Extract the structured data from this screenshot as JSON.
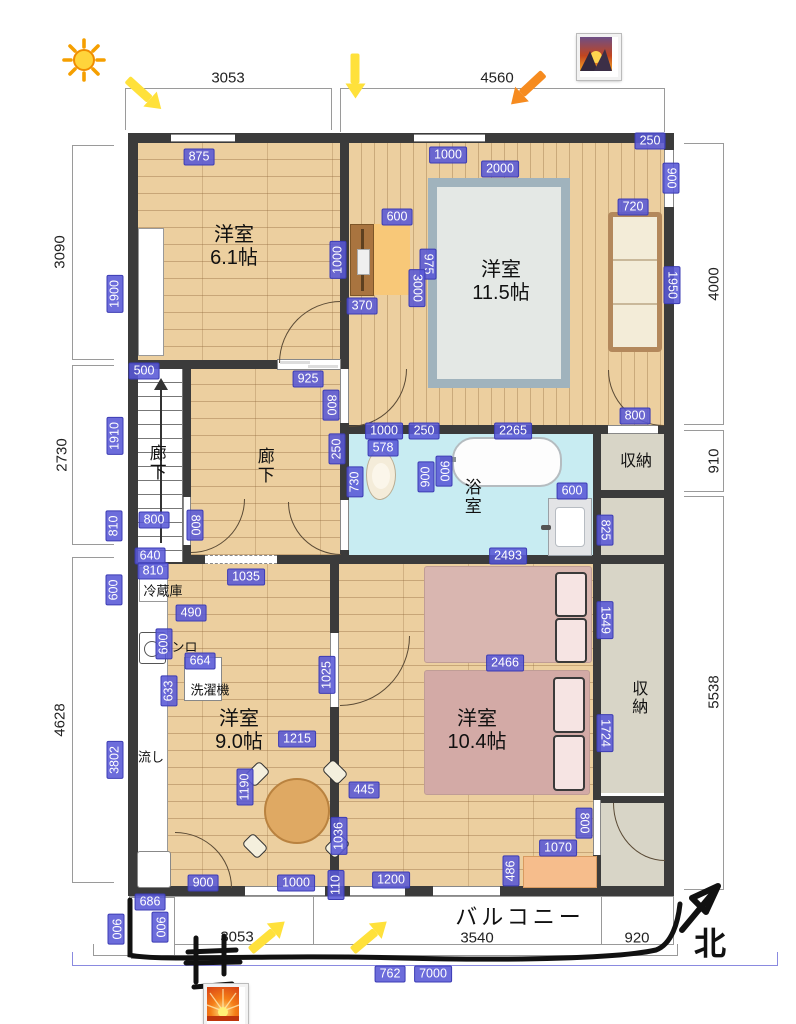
{
  "title": "間取り図 (floor plan)",
  "compass": {
    "label": "北"
  },
  "balcony_label": "バルコニー",
  "colors": {
    "badge_bg": "#5858d6",
    "wall": "#3b3b3b",
    "wood": "#eccf9f",
    "bath_floor": "#c8ecf2",
    "storage": "#d8d5c7",
    "bed": "#d9b6b0",
    "rug_border": "#a0b3bd",
    "rug_inner": "#e4e8e5",
    "arrow_yellow": "#ffe13b",
    "arrow_orange": "#f68b1f"
  },
  "icons": [
    {
      "name": "sun-icon"
    },
    {
      "name": "sunrise-photo-icon-top"
    },
    {
      "name": "sunrise-photo-icon-bottom"
    },
    {
      "name": "yellow-arrow-down-right"
    },
    {
      "name": "yellow-arrow-down"
    },
    {
      "name": "orange-arrow-down-left"
    },
    {
      "name": "yellow-arrow-up-right-1"
    },
    {
      "name": "yellow-arrow-up-right-2"
    },
    {
      "name": "north-arrow"
    }
  ],
  "room_labels": [
    {
      "t": "洋室\n6.1帖",
      "x": 234,
      "y": 247,
      "fs": 20,
      "vert": false
    },
    {
      "t": "洋室\n11.5帖",
      "x": 501,
      "y": 282,
      "fs": 20,
      "vert": false
    },
    {
      "t": "廊下",
      "x": 156,
      "y": 463,
      "fs": 17,
      "vert": true
    },
    {
      "t": "廊下",
      "x": 264,
      "y": 466,
      "fs": 17,
      "vert": true
    },
    {
      "t": "浴室",
      "x": 471,
      "y": 497,
      "fs": 17,
      "vert": true
    },
    {
      "t": "収納",
      "x": 636,
      "y": 462,
      "fs": 16,
      "vert": false
    },
    {
      "t": "収納",
      "x": 637,
      "y": 698,
      "fs": 16,
      "vert": true
    },
    {
      "t": "冷蔵庫",
      "x": 163,
      "y": 592,
      "fs": 13,
      "vert": false
    },
    {
      "t": "コンロ",
      "x": 178,
      "y": 648,
      "fs": 13,
      "vert": false
    },
    {
      "t": "洗濯機",
      "x": 210,
      "y": 691,
      "fs": 13,
      "vert": false
    },
    {
      "t": "流し",
      "x": 151,
      "y": 758,
      "fs": 13,
      "vert": false
    },
    {
      "t": "洋室\n9.0帖",
      "x": 239,
      "y": 731,
      "fs": 20,
      "vert": false
    },
    {
      "t": "洋室\n10.4帖",
      "x": 477,
      "y": 731,
      "fs": 20,
      "vert": false
    },
    {
      "t": "バルコニー",
      "x": 520,
      "y": 917,
      "fs": 22,
      "vert": false
    },
    {
      "t": "北",
      "x": 712,
      "y": 944,
      "fs": 32,
      "vert": false
    }
  ],
  "outer_dimensions": [
    {
      "v": "3053",
      "x": 228,
      "y": 78,
      "o": "h"
    },
    {
      "v": "4560",
      "x": 497,
      "y": 78,
      "o": "h"
    },
    {
      "v": "3090",
      "x": 60,
      "y": 252,
      "o": "v"
    },
    {
      "v": "2730",
      "x": 62,
      "y": 455,
      "o": "v"
    },
    {
      "v": "4628",
      "x": 60,
      "y": 720,
      "o": "v"
    },
    {
      "v": "4000",
      "x": 714,
      "y": 284,
      "o": "v"
    },
    {
      "v": "910",
      "x": 714,
      "y": 461,
      "o": "v"
    },
    {
      "v": "5538",
      "x": 714,
      "y": 692,
      "o": "v"
    },
    {
      "v": "3053",
      "x": 237,
      "y": 937,
      "o": "h"
    },
    {
      "v": "3540",
      "x": 477,
      "y": 938,
      "o": "h"
    },
    {
      "v": "920",
      "x": 637,
      "y": 938,
      "o": "h"
    }
  ],
  "dimension_badges": [
    {
      "v": "875",
      "x": 199,
      "y": 157,
      "o": "h"
    },
    {
      "v": "1000",
      "x": 448,
      "y": 155,
      "o": "h"
    },
    {
      "v": "2000",
      "x": 500,
      "y": 169,
      "o": "h"
    },
    {
      "v": "250",
      "x": 650,
      "y": 141,
      "o": "h"
    },
    {
      "v": "900",
      "x": 671,
      "y": 178,
      "o": "vr"
    },
    {
      "v": "720",
      "x": 633,
      "y": 207,
      "o": "h"
    },
    {
      "v": "600",
      "x": 397,
      "y": 217,
      "o": "h"
    },
    {
      "v": "1900",
      "x": 115,
      "y": 294,
      "o": "v"
    },
    {
      "v": "1000",
      "x": 338,
      "y": 260,
      "o": "v"
    },
    {
      "v": "975",
      "x": 428,
      "y": 264,
      "o": "vr"
    },
    {
      "v": "3000",
      "x": 417,
      "y": 288,
      "o": "vr"
    },
    {
      "v": "370",
      "x": 362,
      "y": 306,
      "o": "h"
    },
    {
      "v": "1950",
      "x": 672,
      "y": 285,
      "o": "vr"
    },
    {
      "v": "800",
      "x": 635,
      "y": 416,
      "o": "h"
    },
    {
      "v": "500",
      "x": 144,
      "y": 371,
      "o": "h"
    },
    {
      "v": "925",
      "x": 308,
      "y": 379,
      "o": "h"
    },
    {
      "v": "800",
      "x": 331,
      "y": 405,
      "o": "vr"
    },
    {
      "v": "1910",
      "x": 115,
      "y": 436,
      "o": "v"
    },
    {
      "v": "250",
      "x": 337,
      "y": 449,
      "o": "v"
    },
    {
      "v": "1000",
      "x": 384,
      "y": 431,
      "o": "h"
    },
    {
      "v": "250",
      "x": 424,
      "y": 431,
      "o": "h"
    },
    {
      "v": "2265",
      "x": 513,
      "y": 431,
      "o": "h"
    },
    {
      "v": "578",
      "x": 383,
      "y": 448,
      "o": "h"
    },
    {
      "v": "730",
      "x": 355,
      "y": 482,
      "o": "v"
    },
    {
      "v": "900",
      "x": 426,
      "y": 477,
      "o": "v"
    },
    {
      "v": "900",
      "x": 444,
      "y": 471,
      "o": "vr"
    },
    {
      "v": "600",
      "x": 572,
      "y": 491,
      "o": "h"
    },
    {
      "v": "825",
      "x": 605,
      "y": 530,
      "o": "vr"
    },
    {
      "v": "810",
      "x": 114,
      "y": 526,
      "o": "v"
    },
    {
      "v": "800",
      "x": 154,
      "y": 520,
      "o": "h"
    },
    {
      "v": "800",
      "x": 195,
      "y": 525,
      "o": "vr"
    },
    {
      "v": "640",
      "x": 150,
      "y": 556,
      "o": "h"
    },
    {
      "v": "810",
      "x": 153,
      "y": 571,
      "o": "h"
    },
    {
      "v": "1035",
      "x": 246,
      "y": 577,
      "o": "h"
    },
    {
      "v": "2493",
      "x": 508,
      "y": 556,
      "o": "h"
    },
    {
      "v": "600",
      "x": 114,
      "y": 590,
      "o": "v"
    },
    {
      "v": "490",
      "x": 191,
      "y": 613,
      "o": "h"
    },
    {
      "v": "600",
      "x": 164,
      "y": 644,
      "o": "v"
    },
    {
      "v": "664",
      "x": 200,
      "y": 661,
      "o": "h"
    },
    {
      "v": "633",
      "x": 169,
      "y": 691,
      "o": "v"
    },
    {
      "v": "1025",
      "x": 327,
      "y": 675,
      "o": "v"
    },
    {
      "v": "1549",
      "x": 605,
      "y": 620,
      "o": "vr"
    },
    {
      "v": "2466",
      "x": 505,
      "y": 663,
      "o": "h"
    },
    {
      "v": "3802",
      "x": 115,
      "y": 760,
      "o": "v"
    },
    {
      "v": "1215",
      "x": 297,
      "y": 739,
      "o": "h"
    },
    {
      "v": "1190",
      "x": 245,
      "y": 787,
      "o": "v"
    },
    {
      "v": "445",
      "x": 364,
      "y": 790,
      "o": "h"
    },
    {
      "v": "1724",
      "x": 605,
      "y": 733,
      "o": "vr"
    },
    {
      "v": "1036",
      "x": 339,
      "y": 836,
      "o": "v"
    },
    {
      "v": "800",
      "x": 584,
      "y": 823,
      "o": "vr"
    },
    {
      "v": "1070",
      "x": 558,
      "y": 848,
      "o": "h"
    },
    {
      "v": "486",
      "x": 511,
      "y": 871,
      "o": "v"
    },
    {
      "v": "110",
      "x": 336,
      "y": 885,
      "o": "v"
    },
    {
      "v": "900",
      "x": 203,
      "y": 883,
      "o": "h"
    },
    {
      "v": "1000",
      "x": 296,
      "y": 883,
      "o": "h"
    },
    {
      "v": "1200",
      "x": 391,
      "y": 880,
      "o": "h"
    },
    {
      "v": "686",
      "x": 150,
      "y": 902,
      "o": "h"
    },
    {
      "v": "900",
      "x": 116,
      "y": 929,
      "o": "vr"
    },
    {
      "v": "900",
      "x": 160,
      "y": 927,
      "o": "vr"
    },
    {
      "v": "762",
      "x": 390,
      "y": 974,
      "o": "h"
    },
    {
      "v": "7000",
      "x": 433,
      "y": 974,
      "o": "h"
    }
  ]
}
